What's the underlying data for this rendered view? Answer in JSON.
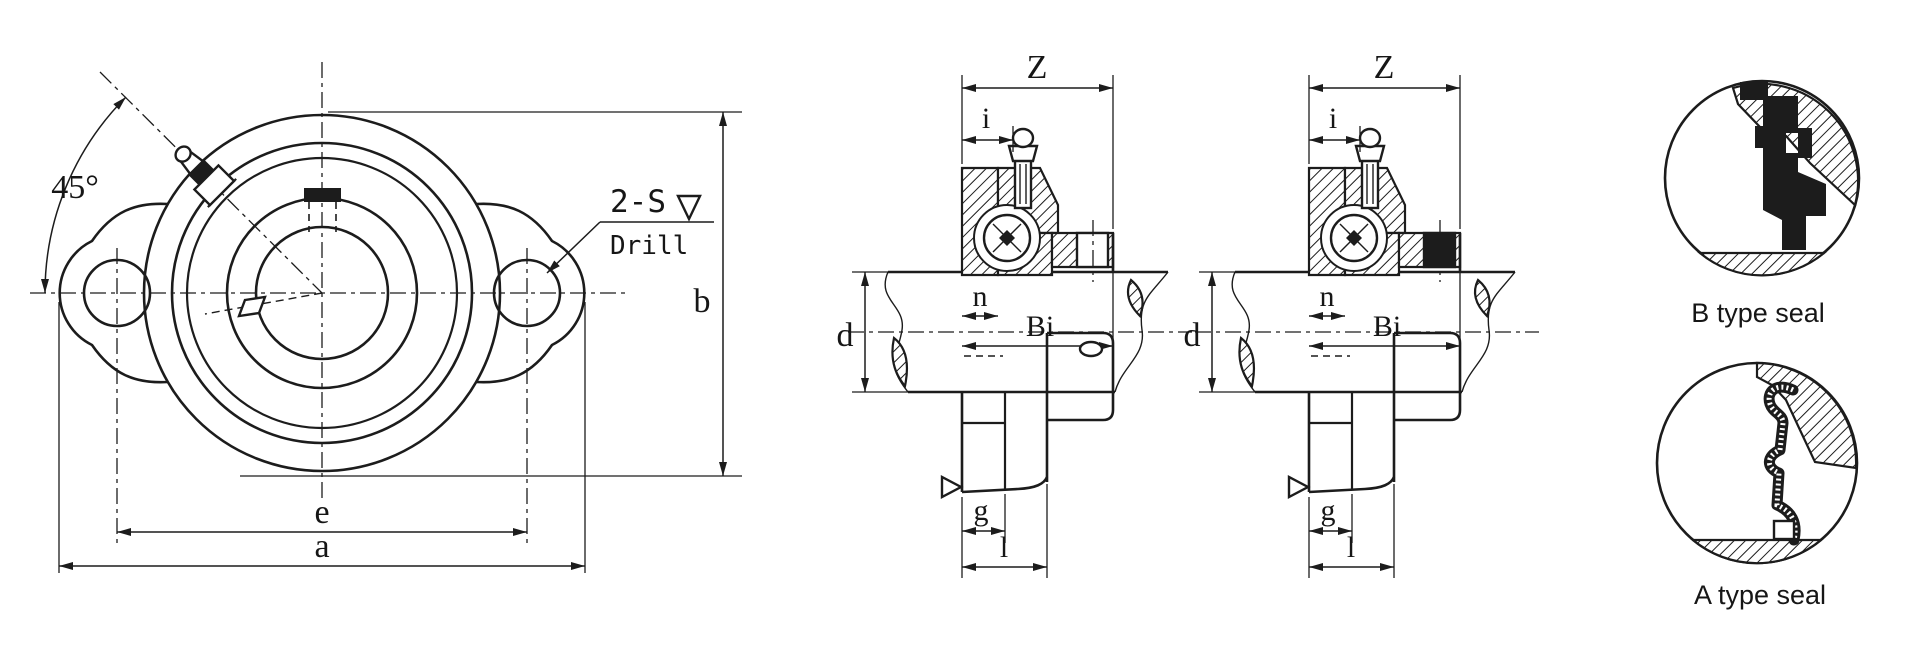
{
  "page": {
    "background": "#ffffff",
    "ink": "#1c1c1c"
  },
  "front_view": {
    "angle_label": "45°",
    "drill_note_top": "2-S",
    "drill_note_bottom": "Drill",
    "dim_e": "e",
    "dim_a": "a",
    "dim_b": "b"
  },
  "section_views": [
    {
      "dim_z": "Z",
      "dim_i": "i",
      "dim_n": "n",
      "dim_bi": "Bi",
      "dim_d": "d",
      "dim_g": "g",
      "dim_l": "l"
    },
    {
      "dim_z": "Z",
      "dim_i": "i",
      "dim_n": "n",
      "dim_bi": "Bi",
      "dim_d": "d",
      "dim_g": "g",
      "dim_l": "l"
    }
  ],
  "seal_details": [
    {
      "label": "B type seal"
    },
    {
      "label": "A type seal"
    }
  ]
}
